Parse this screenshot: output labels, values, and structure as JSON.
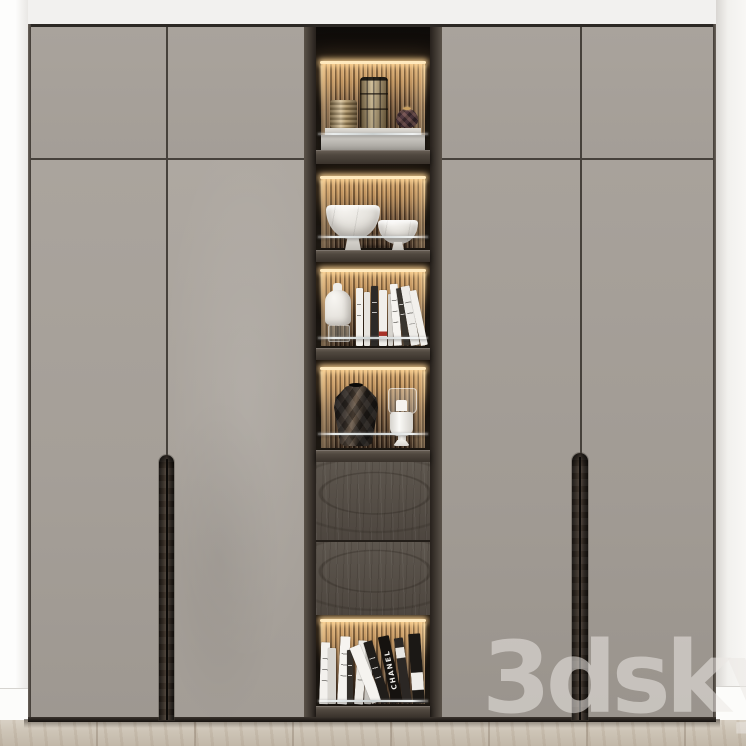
{
  "watermark": {
    "text": "3dsky"
  },
  "book_spines": {
    "visible_title": "CHANEL"
  },
  "palette": {
    "wall": "#f2f1ef",
    "side_wall": "#fbfaf8",
    "door_grey": "#a7a19a",
    "seam": "#46413b",
    "frame_dark": "#1c1713",
    "drawer_wood": "#564f48",
    "slat_lit": "#dcb684",
    "slat_shadow": "#3e2e22",
    "led_glow": "#ffe9bd",
    "marble": "#eceae6",
    "brass": "#ab9264",
    "dark_vase": "#2a241f",
    "floor": "#ccc3b6"
  },
  "wardrobe": {
    "left_upper_doors": 2,
    "left_lower_doors": 2,
    "right_upper_doors": 2,
    "right_lower_doors": 2,
    "handles": [
      "left recessed wood pull",
      "right recessed wood pull"
    ],
    "display_column": {
      "compartments": [
        {
          "label": "top shelf",
          "items": [
            "ribbed metal canister",
            "tall brass canister",
            "faceted plum mini vase",
            "stone display tray"
          ]
        },
        {
          "label": "bowl shelf",
          "items": [
            "large marble footed bowl",
            "small marble bowl"
          ]
        },
        {
          "label": "book shelf",
          "items": [
            "white bottle vase",
            "row of books"
          ]
        },
        {
          "label": "vase shelf",
          "items": [
            "dark faceted vase",
            "glass hurricane candle holder"
          ]
        },
        {
          "label": "drawers",
          "items": [
            "upper drawer front",
            "lower drawer front"
          ]
        },
        {
          "label": "bottom book shelf",
          "items": [
            "white book stack",
            "designer book stack"
          ]
        }
      ]
    }
  }
}
